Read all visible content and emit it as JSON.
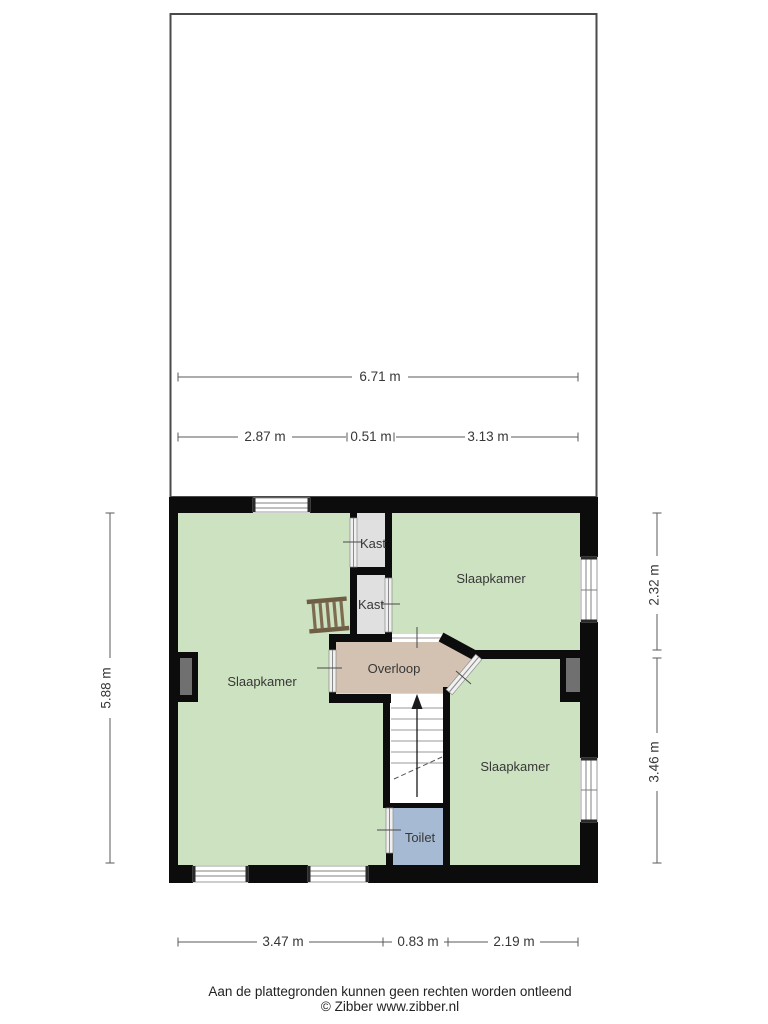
{
  "plan": {
    "type": "floorplan",
    "rooms": {
      "slaapkamer_left": "Slaapkamer",
      "slaapkamer_top_right": "Slaapkamer",
      "slaapkamer_bottom_right": "Slaapkamer",
      "kast_top": "Kast",
      "kast_bottom": "Kast",
      "overloop": "Overloop",
      "toilet": "Toilet"
    },
    "colors": {
      "wall": "#0c0c0c",
      "room_green": "#cde2c0",
      "hall_tan": "#d3c2b1",
      "closet_gray": "#e0e0e0",
      "toilet_blue": "#a6bbd3",
      "chimney_gray": "#707070",
      "ladder_brown": "#6f5e46"
    },
    "dimensions": {
      "attic_total": "6.71 m",
      "attic_seg_left": "2.87 m",
      "attic_seg_mid": "0.51 m",
      "attic_seg_right": "3.13 m",
      "left_height": "5.88 m",
      "right_top": "2.32 m",
      "right_bottom": "3.46 m",
      "bottom_left": "3.47 m",
      "bottom_mid": "0.83 m",
      "bottom_right": "2.19 m"
    }
  },
  "footer": {
    "disclaimer": "Aan de plattegronden kunnen geen rechten worden ontleend",
    "copyright": "© Zibber www.zibber.nl"
  }
}
